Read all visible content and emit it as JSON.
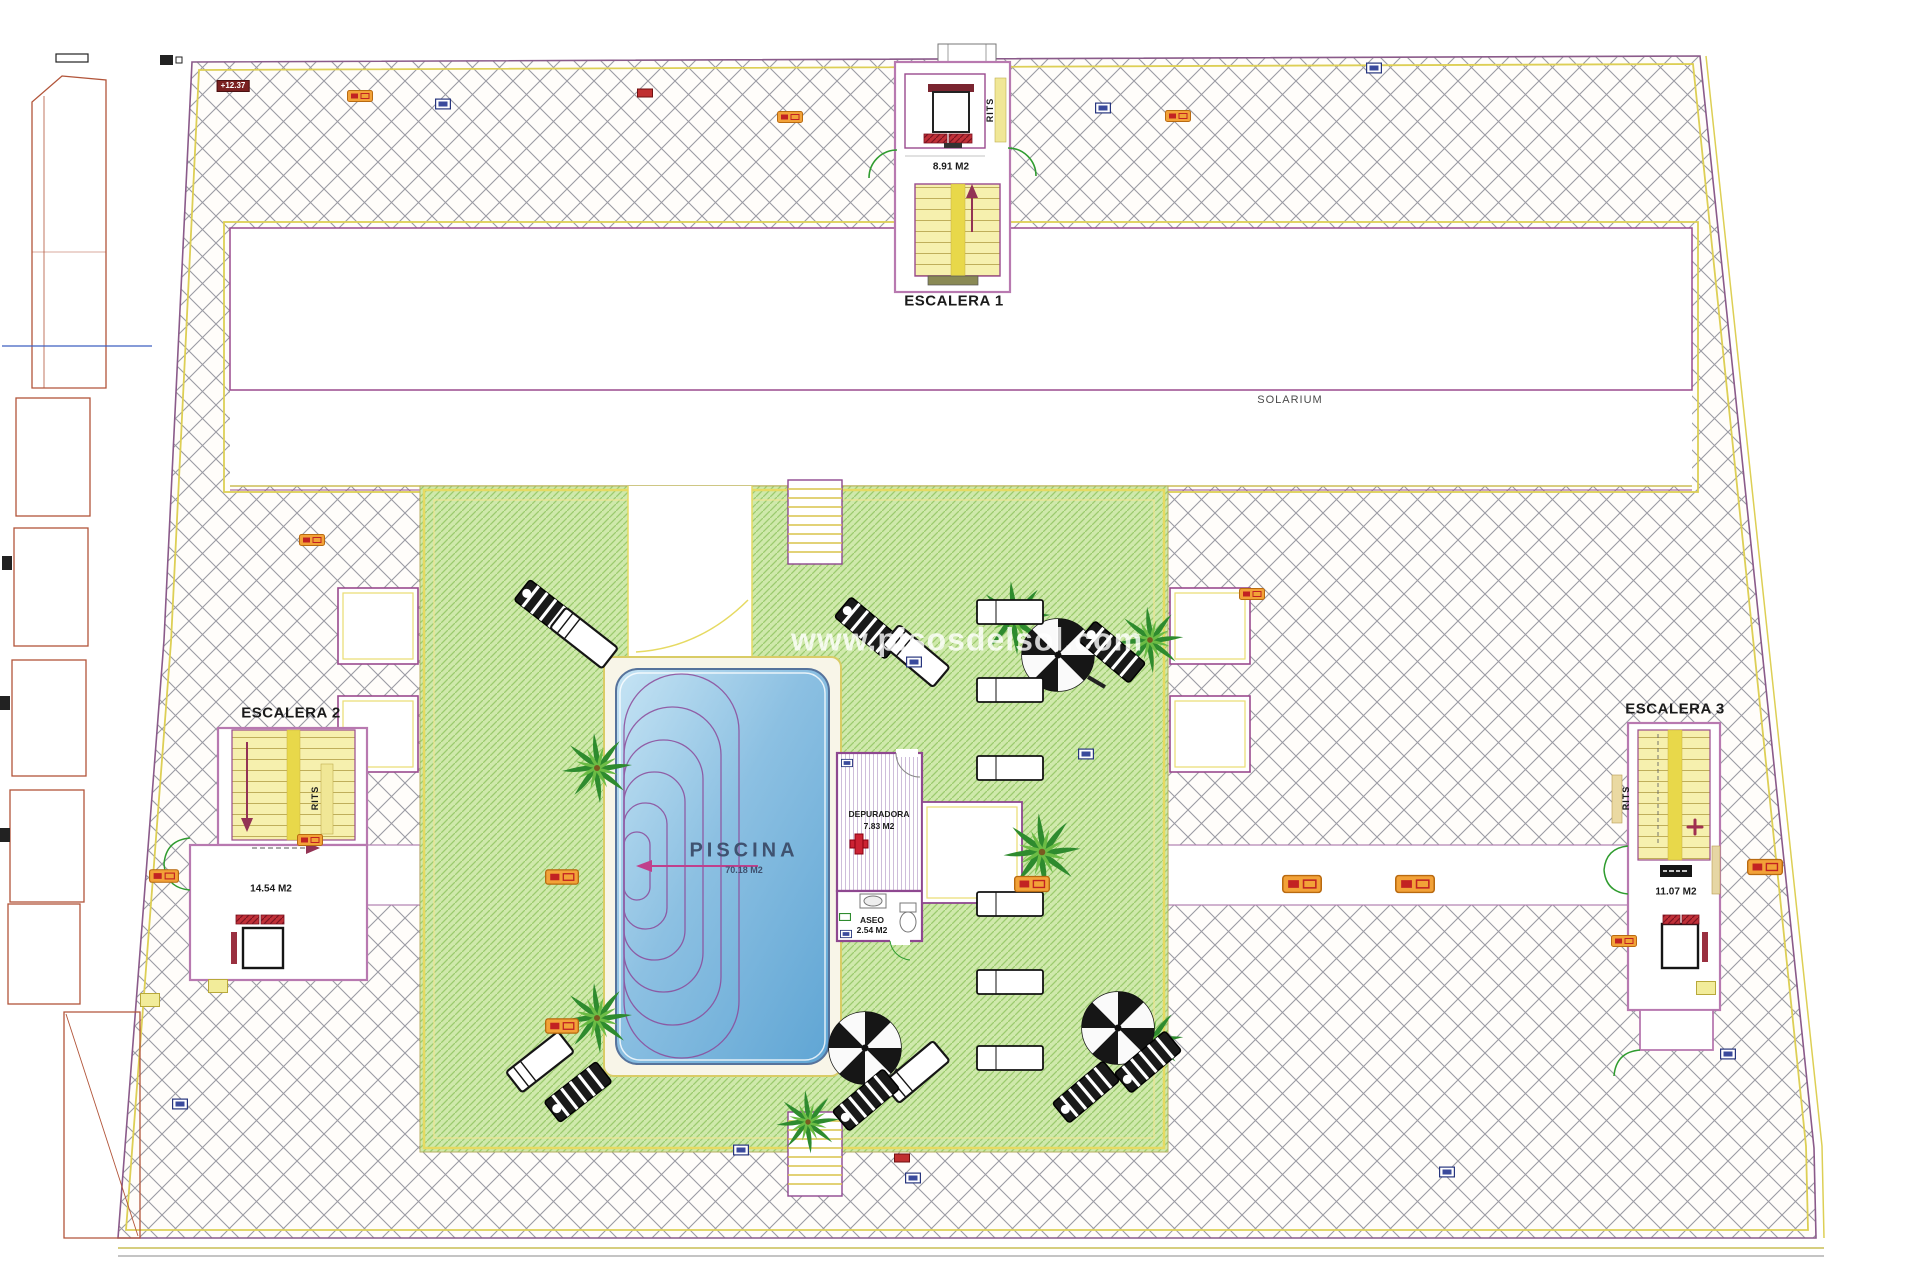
{
  "plan": {
    "watermark": "www.pisosdelsol.com",
    "solarium_label": "SOLARIUM",
    "level_marker": "+12.37",
    "stairwells": {
      "escalera1": {
        "name": "ESCALERA 1",
        "area": "8.91 M2",
        "rits": "RITS"
      },
      "escalera2": {
        "name": "ESCALERA 2",
        "area": "14.54 M2",
        "rits": "RITS"
      },
      "escalera3": {
        "name": "ESCALERA 3",
        "area": "11.07 M2",
        "rits": "RITS"
      }
    },
    "pool": {
      "name": "PISCINA",
      "area": "70.18 M2"
    },
    "rooms": {
      "depuradora": {
        "name": "DEPURADORA",
        "area": "7.83 M2"
      },
      "aseo": {
        "name": "ASEO",
        "area": "2.54 M2"
      }
    },
    "colors": {
      "deck_green": "#cfe9ab",
      "pool_blue": "#7fb8dd",
      "hatch_gray": "#9b9ba4",
      "boundary_yellow": "#e6da62",
      "wall_purple": "#9a4a8e",
      "marker_orange": "#f2a238"
    }
  }
}
